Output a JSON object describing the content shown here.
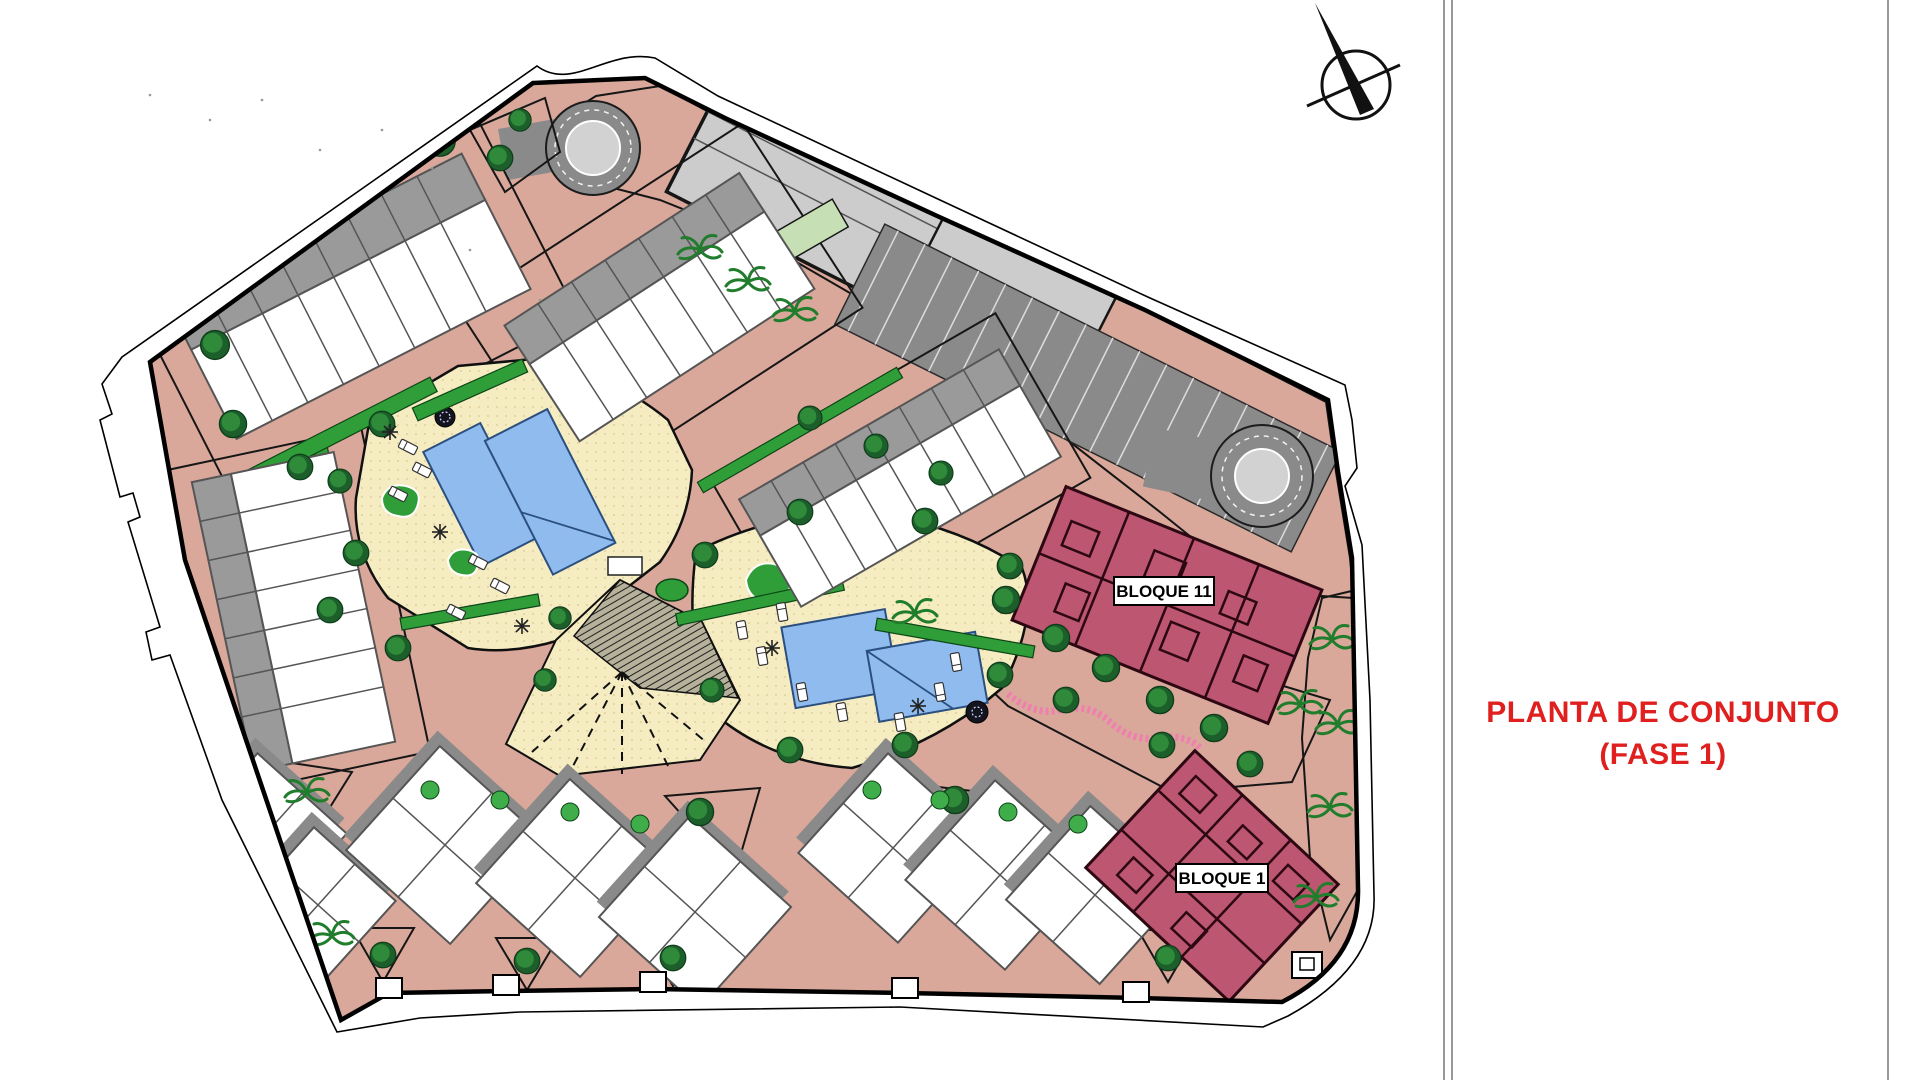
{
  "page": {
    "background": "#ffffff"
  },
  "title": {
    "line1": "PLANTA DE CONJUNTO",
    "line2": "(FASE 1)",
    "color": "#e01f1f"
  },
  "plan": {
    "labels": {
      "bloque11": "BLOQUE 11",
      "bloque1": "BLOQUE 1"
    },
    "icons": {
      "north_arrow": "north-arrow-compass"
    },
    "palette": {
      "road_salmon": "#d9a89a",
      "road_gray_light": "#d2d2d2",
      "deck_gray": "#cccccc",
      "parking_gray": "#8a8a8a",
      "lawn_green": "#c6dfb4",
      "hedge_green": "#2f9e38",
      "bush_green": "#3fae4a",
      "palm_green": "#1f7d2c",
      "tree_dark": "#1c5f2b",
      "tree_mid": "#2f8b3a",
      "courtyard_cream": "#f5ecc2",
      "courtyard_dot": "#d9c88e",
      "pool_blue": "#8fbbee",
      "pool_line": "#2b4f7e",
      "building_roof_gray": "#9a9a9a",
      "building_line": "#555555",
      "bloque_maroon": "#bc5671",
      "bloque_line": "#2d0813",
      "plaza_hatch_bg": "#b5b19a",
      "path_pink": "#ef7fae",
      "outline_black": "#000000",
      "title_red": "#e01f1f",
      "divider_gray": "#777777"
    }
  }
}
